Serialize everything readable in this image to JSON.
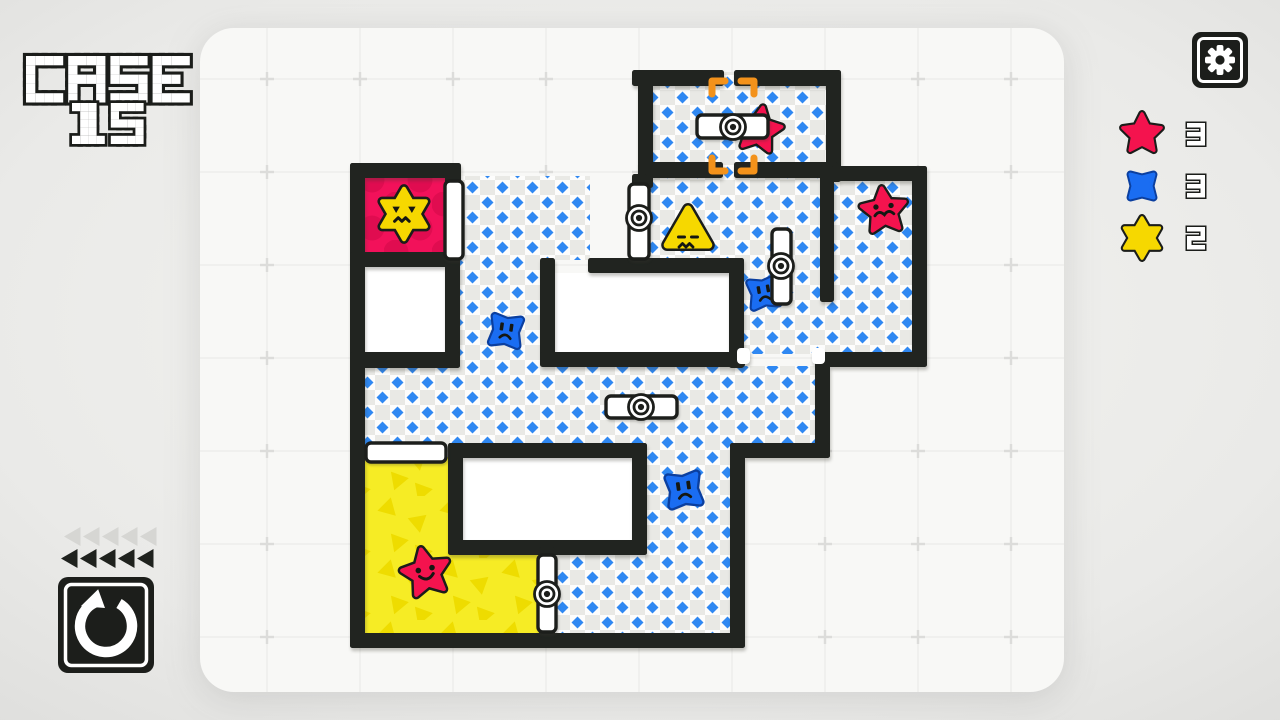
{
  "title": {
    "line1": "CASE",
    "line2": "15"
  },
  "colors": {
    "wall": "#212420",
    "panel": "#f8f8f6",
    "page_center": "#f4f4f1",
    "page_edge": "#dfdfdd",
    "floor_white": "#fdfdfc",
    "floor_gray": "#e9e9e5",
    "diamond": "#2f88f2",
    "pink_bg": "#f2115a",
    "pink_dot": "#e00c50",
    "yellow_bg": "#f6ec25",
    "yellow_tri": "#eedc00",
    "red": "#f4134e",
    "blue": "#1a6df2",
    "blue_outline": "#0b3f9f",
    "yellow": "#f6d800",
    "outline": "#1b1d1a",
    "door_fill": "#ffffff",
    "bracket": "#f3921b",
    "tri_gray": "#d6d6d3",
    "grid_line": "#ededeb",
    "grid_cross": "#dcdcda"
  },
  "board": {
    "panel": {
      "x": 200,
      "y": 28,
      "w": 864,
      "h": 664,
      "r": 34
    },
    "grid": {
      "x0": 267,
      "y0": 79,
      "step": 93
    },
    "holes": [
      [
        365,
        267,
        80,
        86
      ],
      [
        555,
        273,
        174,
        80
      ],
      [
        463,
        458,
        169,
        83
      ]
    ],
    "floors": [
      [
        650,
        84,
        178,
        82
      ],
      [
        720,
        72,
        18,
        106
      ],
      [
        650,
        176,
        172,
        84
      ],
      [
        742,
        176,
        90,
        178
      ],
      [
        832,
        181,
        82,
        173
      ],
      [
        460,
        176,
        130,
        84
      ],
      [
        460,
        258,
        82,
        112
      ],
      [
        364,
        366,
        452,
        79
      ],
      [
        647,
        443,
        85,
        114
      ],
      [
        555,
        553,
        177,
        82
      ]
    ],
    "pink_room": [
      364,
      177,
      83,
      77
    ],
    "yellow_room": [
      [
        364,
        457,
        85,
        178
      ],
      [
        447,
        553,
        93,
        82
      ]
    ],
    "walls": [
      [
        632,
        70,
        92,
        16
      ],
      [
        734,
        70,
        107,
        16
      ],
      [
        826,
        70,
        15,
        112
      ],
      [
        638,
        70,
        15,
        118
      ],
      [
        638,
        162,
        85,
        16
      ],
      [
        734,
        162,
        104,
        16
      ],
      [
        826,
        166,
        101,
        15
      ],
      [
        912,
        166,
        15,
        201
      ],
      [
        820,
        166,
        14,
        136
      ],
      [
        588,
        258,
        156,
        15
      ],
      [
        540,
        258,
        15,
        100
      ],
      [
        729,
        258,
        15,
        110
      ],
      [
        540,
        352,
        205,
        15
      ],
      [
        815,
        352,
        112,
        15
      ],
      [
        815,
        352,
        15,
        106
      ],
      [
        730,
        443,
        100,
        15
      ],
      [
        730,
        443,
        15,
        205
      ],
      [
        350,
        633,
        395,
        15
      ],
      [
        350,
        163,
        15,
        485
      ],
      [
        350,
        163,
        110,
        15
      ],
      [
        350,
        252,
        110,
        15
      ],
      [
        445,
        163,
        16,
        24
      ],
      [
        445,
        252,
        15,
        116
      ],
      [
        350,
        352,
        110,
        16
      ],
      [
        448,
        443,
        199,
        15
      ],
      [
        632,
        443,
        15,
        112
      ],
      [
        448,
        443,
        15,
        112
      ],
      [
        448,
        540,
        199,
        15
      ],
      [
        632,
        174,
        15,
        14
      ],
      [
        539,
        547,
        16,
        11
      ],
      [
        539,
        628,
        16,
        10
      ]
    ],
    "jamb_caps": [
      [
        737,
        348,
        13,
        16
      ],
      [
        812,
        348,
        13,
        16
      ]
    ],
    "doors": [
      {
        "x": 697,
        "y": 115,
        "w": 71,
        "h": 23,
        "pivot": [
          733,
          127
        ]
      },
      {
        "x": 629,
        "y": 184,
        "w": 20,
        "h": 75,
        "pivot": [
          639,
          218
        ]
      },
      {
        "x": 772,
        "y": 229,
        "w": 19,
        "h": 75,
        "pivot": [
          781,
          266
        ]
      },
      {
        "x": 606,
        "y": 396,
        "w": 71,
        "h": 22,
        "pivot": [
          641,
          407
        ]
      },
      {
        "x": 445,
        "y": 181,
        "w": 18,
        "h": 78
      },
      {
        "x": 366,
        "y": 443,
        "w": 80,
        "h": 19
      },
      {
        "x": 538,
        "y": 555,
        "w": 18,
        "h": 77,
        "pivot": [
          547,
          594
        ]
      }
    ],
    "brackets": {
      "cx": 733,
      "cy": 126,
      "hw": 21,
      "hh": 45,
      "arm": 13
    },
    "creatures": [
      {
        "type": "star6",
        "color": "yellow",
        "face": "angry",
        "x": 404,
        "y": 214,
        "s": 1.05,
        "rot": 0,
        "behind": false
      },
      {
        "type": "star5",
        "color": "red",
        "face": "grumpy",
        "x": 759,
        "y": 130,
        "s": 0.95,
        "rot": 10,
        "behind": true
      },
      {
        "type": "star5",
        "color": "red",
        "face": "mustache",
        "x": 884,
        "y": 211,
        "s": 0.95,
        "rot": -6,
        "behind": false
      },
      {
        "type": "tri3",
        "color": "yellow",
        "face": "cross",
        "x": 688,
        "y": 233,
        "s": 1.0,
        "rot": 0,
        "behind": false
      },
      {
        "type": "cross4",
        "color": "blue",
        "face": "sad",
        "x": 764,
        "y": 293,
        "s": 0.85,
        "rot": -10,
        "behind": true
      },
      {
        "type": "cross4",
        "color": "blue",
        "face": "sad",
        "x": 506,
        "y": 331,
        "s": 0.88,
        "rot": 8,
        "behind": false
      },
      {
        "type": "cross4",
        "color": "blue",
        "face": "sad",
        "x": 684,
        "y": 490,
        "s": 0.95,
        "rot": -8,
        "behind": false
      },
      {
        "type": "star5",
        "color": "red",
        "face": "happy",
        "x": 426,
        "y": 573,
        "s": 1.0,
        "rot": -12,
        "behind": false
      }
    ]
  },
  "hud": {
    "gear_icon": "settings-gear",
    "undo_icon": "undo-rotate-ccw",
    "history_triangles": {
      "gray": 5,
      "black": 5
    },
    "legend": [
      {
        "icon": "star5",
        "color": "red",
        "count": "3"
      },
      {
        "icon": "cross4",
        "color": "blue",
        "count": "3"
      },
      {
        "icon": "star6",
        "color": "yellow",
        "count": "2"
      }
    ]
  }
}
